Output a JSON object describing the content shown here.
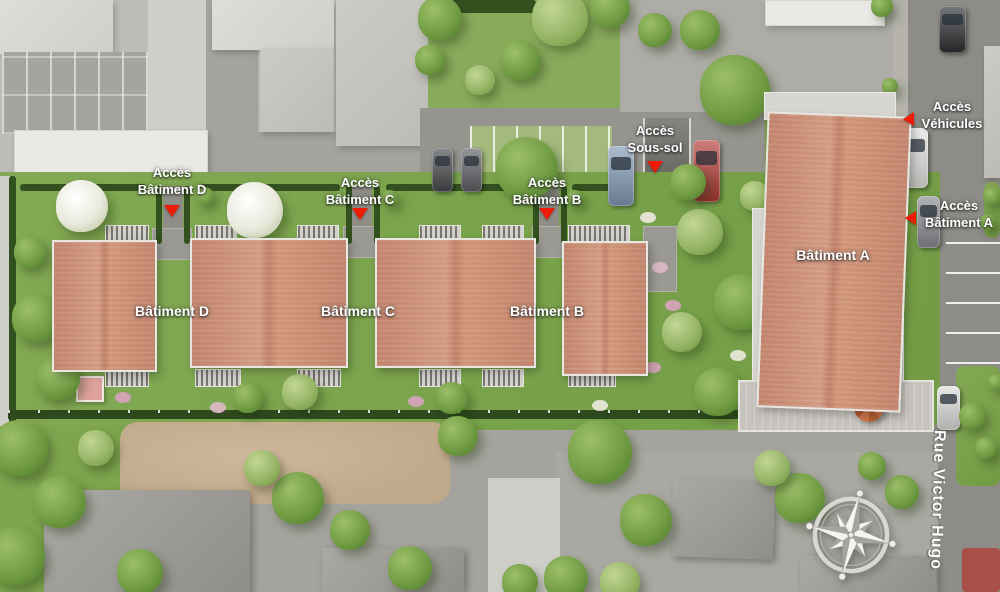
{
  "palette": {
    "accent_red": "#ed1c07",
    "roof_salmon": "#ca8e75",
    "lawn_green": "#7ca44e",
    "label_white": "#ffffff"
  },
  "access_labels": {
    "batiment_d": {
      "line1": "Accès",
      "line2": "Bâtiment D"
    },
    "batiment_c": {
      "line1": "Accès",
      "line2": "Bâtiment C"
    },
    "batiment_b": {
      "line1": "Accès",
      "line2": "Bâtiment B"
    },
    "sous_sol": {
      "line1": "Accès",
      "line2": "Sous-sol"
    },
    "vehicules": {
      "line1": "Accès",
      "line2": "Véhicules"
    },
    "batiment_a": {
      "line1": "Accès",
      "line2": "Bâtiment A"
    }
  },
  "building_labels": {
    "a": "Bâtiment A",
    "b": "Bâtiment B",
    "c": "Bâtiment C",
    "d": "Bâtiment D"
  },
  "street": {
    "name": "Rue Victor Hugo"
  },
  "icons": {
    "compass": "compass-rose",
    "access_marker": "red-triangle-marker"
  }
}
